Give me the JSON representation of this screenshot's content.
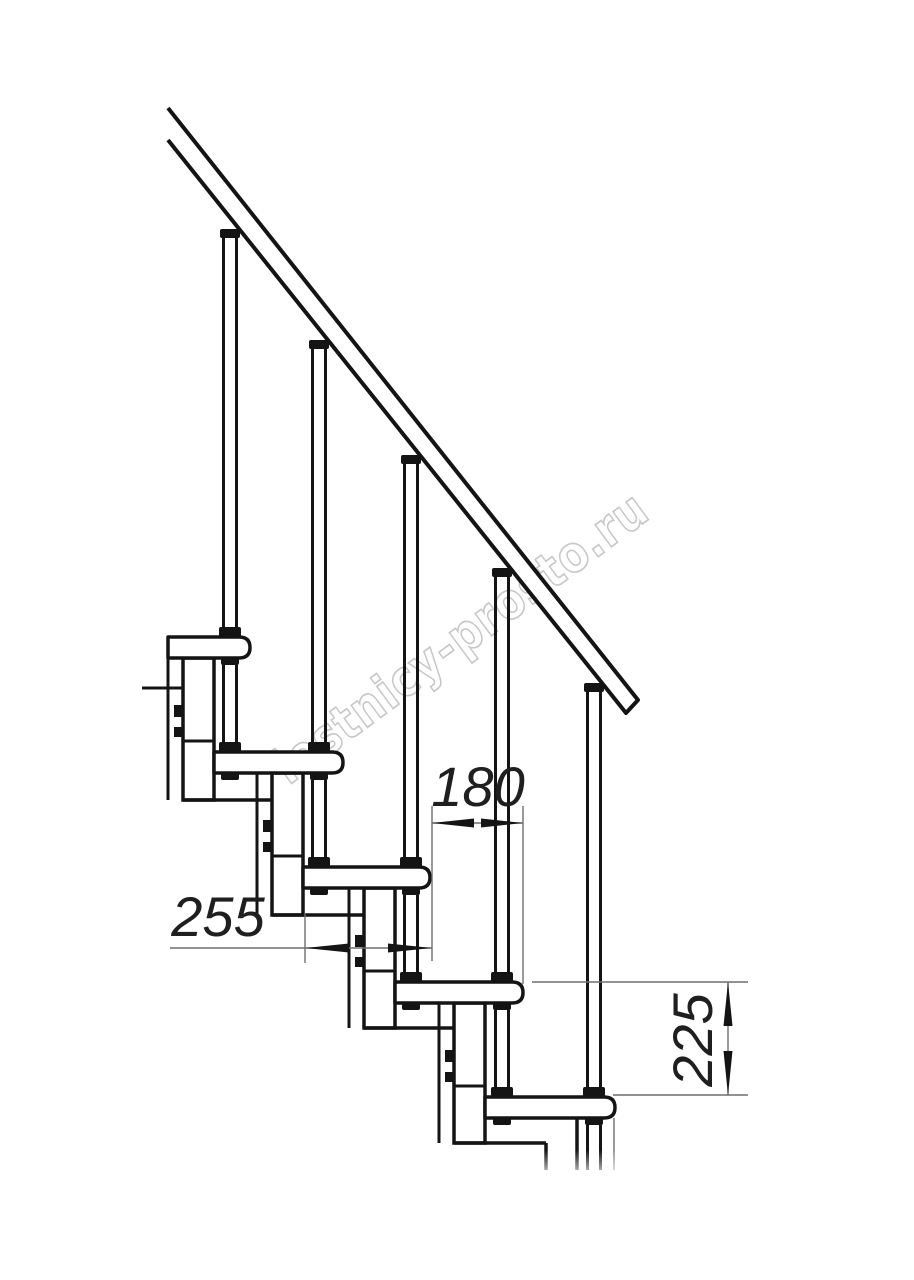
{
  "watermark": {
    "text": "lestnicy-prosto.ru"
  },
  "dimensions": {
    "tread_depth": {
      "value": "255"
    },
    "step_offset": {
      "value": "180"
    },
    "riser_height": {
      "value": "225"
    }
  },
  "colors": {
    "line": "#141414",
    "dimension": "#6f6f6f",
    "text": "#1f1f1f",
    "watermark": "#c8c8c8",
    "background": "#ffffff"
  }
}
